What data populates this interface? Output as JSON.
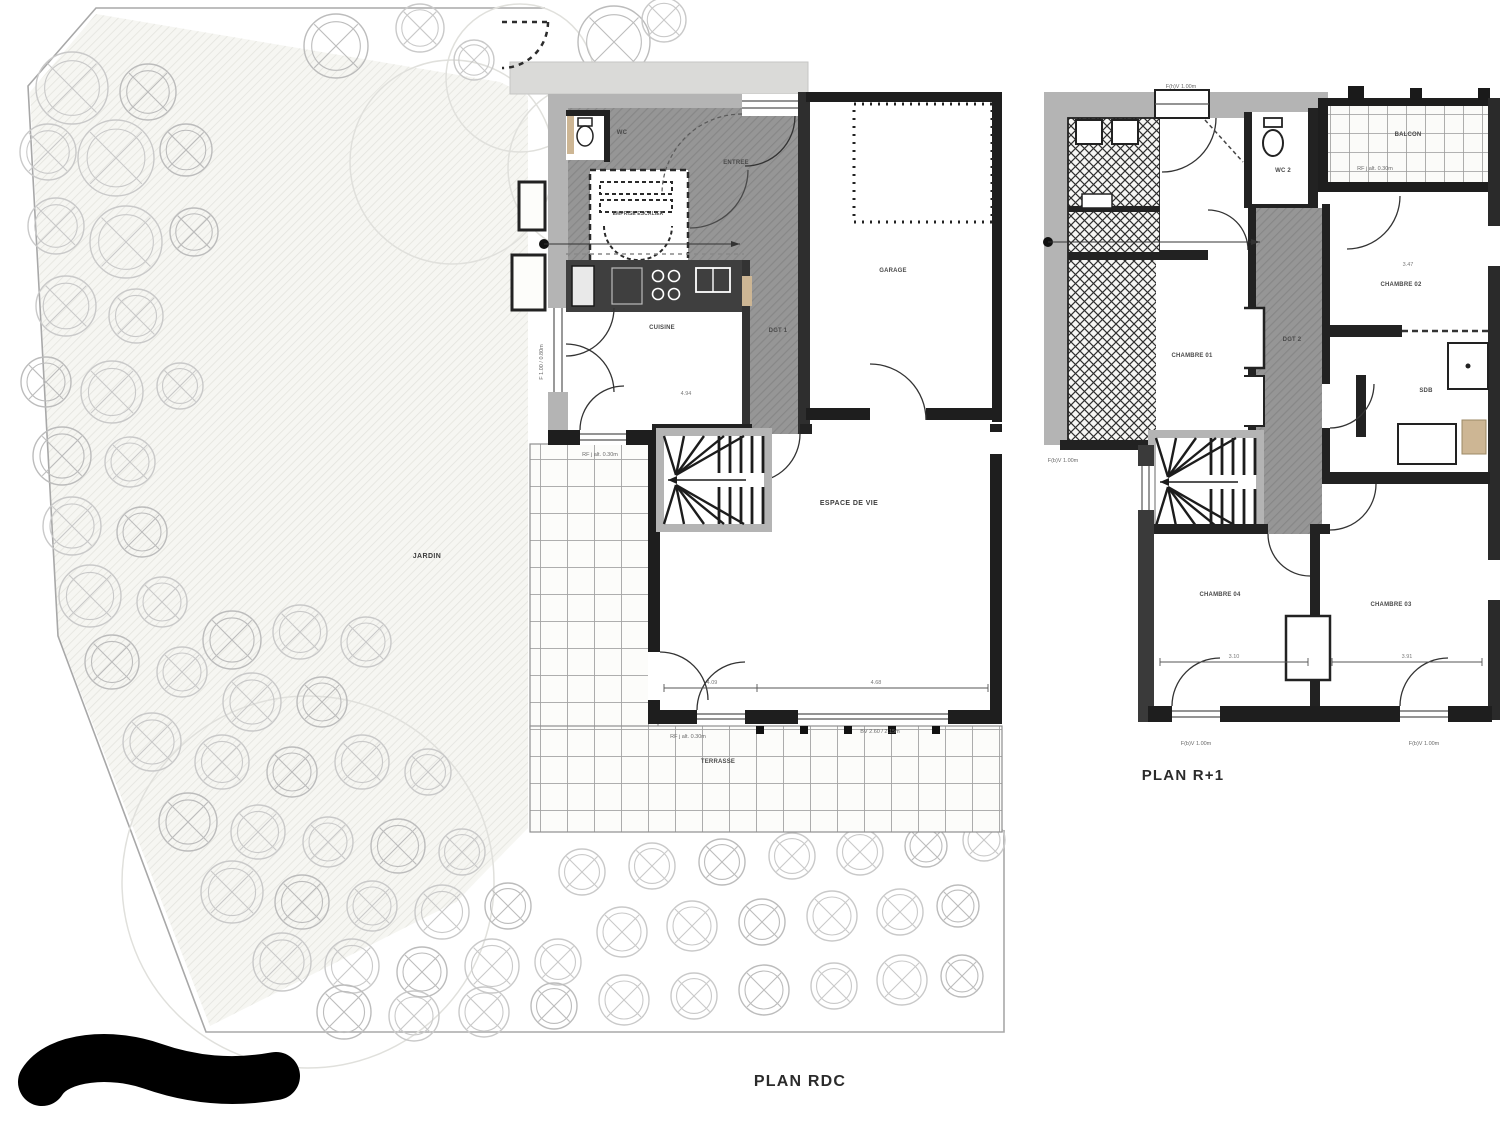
{
  "document": {
    "type": "architectural floor plan drawing"
  },
  "plans": {
    "rdc": {
      "title": "PLAN RDC",
      "rooms": {
        "wc": "WC",
        "entree": "ENTREE",
        "emprise_escalier": "EMPRISE ESCALIER",
        "cuisine": "CUISINE",
        "dgt1": "DGT 1",
        "garage": "GARAGE",
        "espace_de_vie": "ESPACE DE VIE",
        "jardin": "JARDIN",
        "terrasse": "TERRASSE"
      },
      "annotations": {
        "left_door": "F 1.00 / 0.80m",
        "terrace_left_level": "RF j alt. 0.30m",
        "terrace_level": "RF j alt. 0.30m",
        "bay_window": "BV 2.60 / 2.15m",
        "dim_cuisine": "4.94",
        "dim_espace_a": "4.09",
        "dim_espace_b": "4.68"
      }
    },
    "r1": {
      "title": "PLAN R+1",
      "rooms": {
        "wc2": "WC 2",
        "balcon": "BALCON",
        "chambre01": "CHAMBRE 01",
        "chambre02": "CHAMBRE 02",
        "dgt2": "DGT 2",
        "sdb": "SDB",
        "chambre04": "CHAMBRE 04",
        "chambre03": "CHAMBRE 03"
      },
      "annotations": {
        "top_window": "F(h)V 1.00m",
        "balcony_level": "RF j alt. 0.30m",
        "left_window": "F(b)V 1.00m",
        "window_ch04": "F(b)V 1.00m",
        "window_ch03": "F(b)V 1.00m",
        "dim_ch02": "3.47",
        "dim_ch04": "3.10",
        "dim_ch03": "3.91"
      }
    }
  },
  "colors": {
    "wall_gray": "#b4b4b4",
    "wall_dark": "#222222",
    "floor_gray": "#959595",
    "tile_line": "#a3a3a3",
    "tree_stroke": "#c6c6c6",
    "ink": "#2b2b2b",
    "wood": "#cdb694"
  }
}
